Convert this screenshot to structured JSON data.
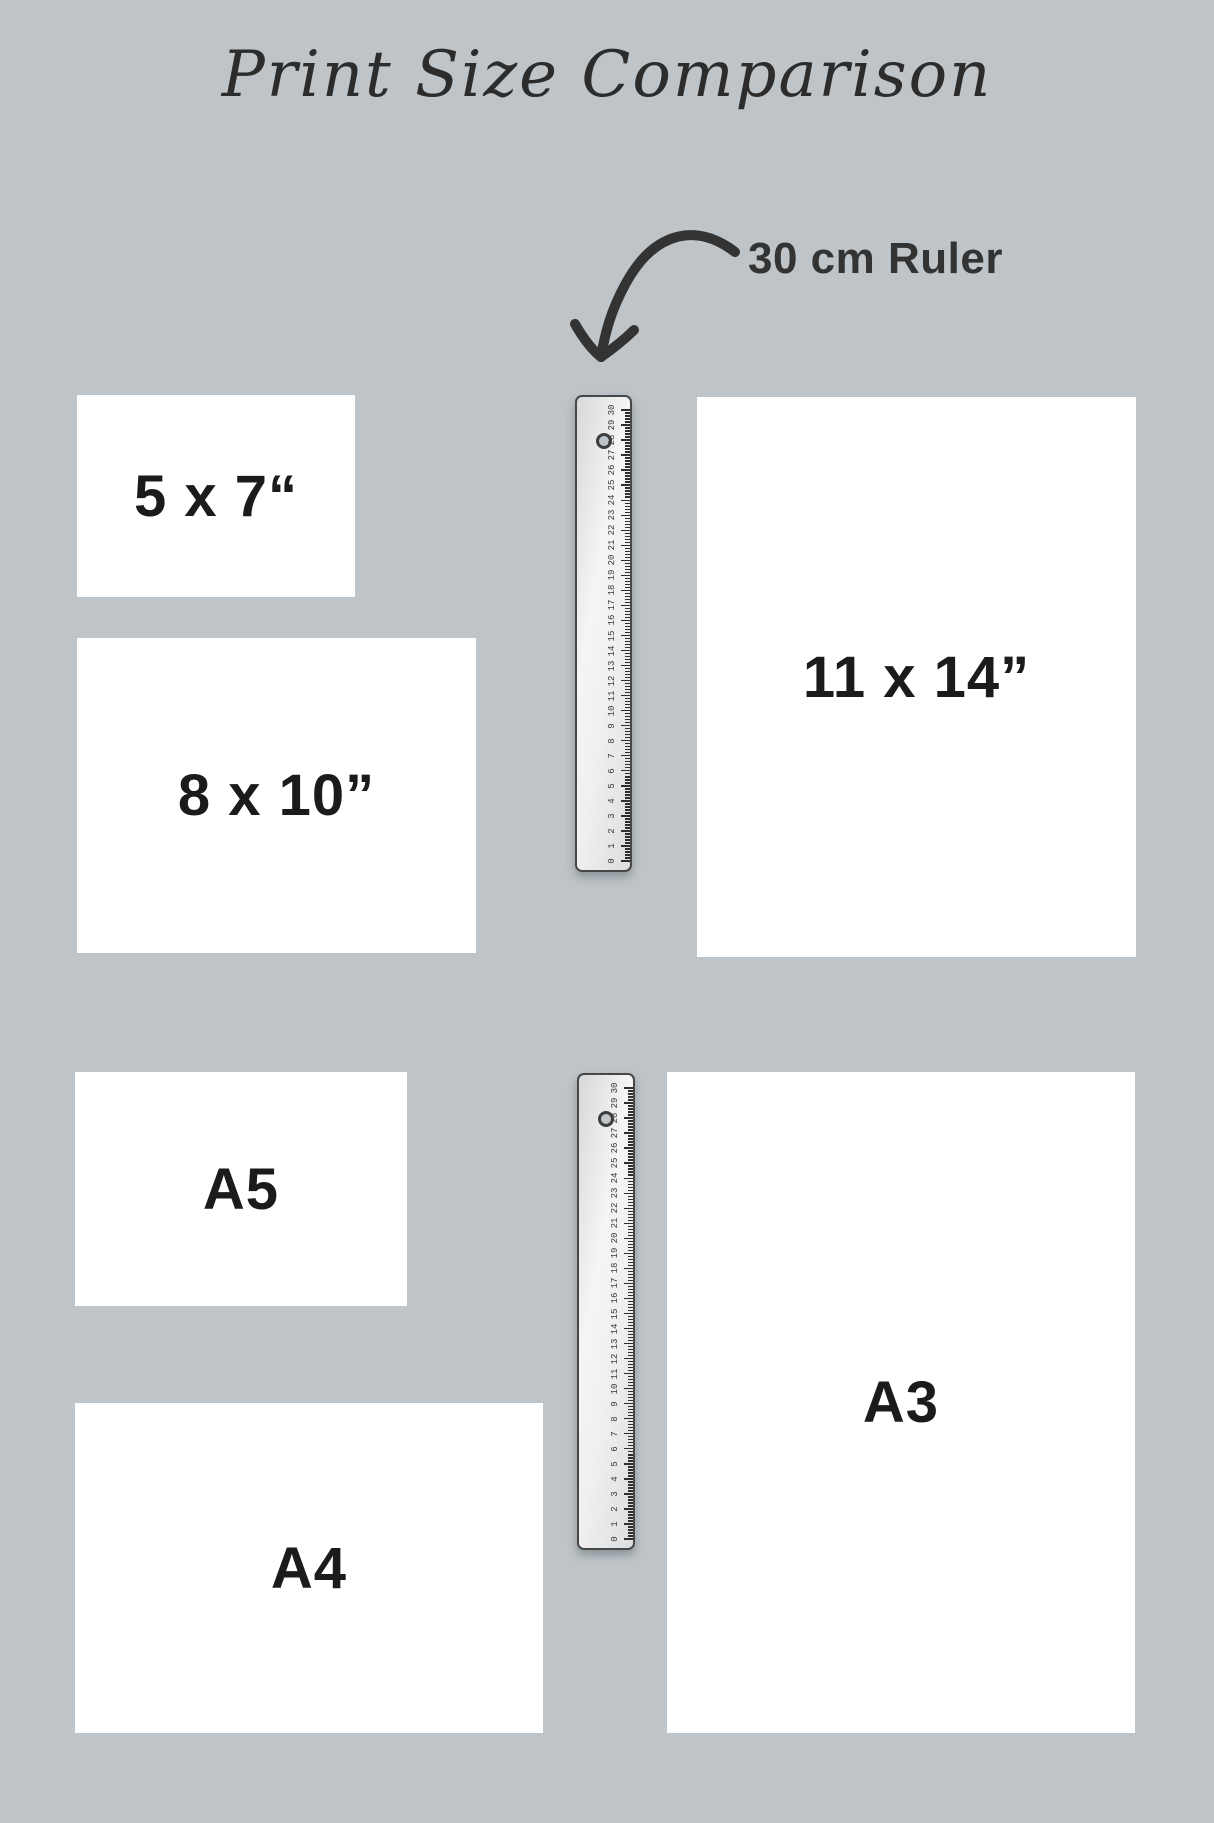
{
  "title": {
    "text": "Print Size Comparison"
  },
  "annotation": {
    "label": "30 cm Ruler"
  },
  "prints": [
    {
      "id": "5x7",
      "label": "5 x 7“",
      "x": 77,
      "y": 395,
      "w": 278,
      "h": 202
    },
    {
      "id": "8x10",
      "label": "8 x 10”",
      "x": 77,
      "y": 638,
      "w": 399,
      "h": 315
    },
    {
      "id": "11x14",
      "label": "11 x 14”",
      "x": 697,
      "y": 397,
      "w": 439,
      "h": 560
    },
    {
      "id": "a5",
      "label": "A5",
      "x": 75,
      "y": 1072,
      "w": 332,
      "h": 234
    },
    {
      "id": "a4",
      "label": "A4",
      "x": 75,
      "y": 1403,
      "w": 468,
      "h": 330
    },
    {
      "id": "a3",
      "label": "A3",
      "x": 667,
      "y": 1072,
      "w": 468,
      "h": 661
    }
  ],
  "rulers": [
    {
      "id": "ruler-top",
      "x": 575,
      "y": 395,
      "w": 57,
      "h": 477
    },
    {
      "id": "ruler-bottom",
      "x": 577,
      "y": 1073,
      "w": 58,
      "h": 477
    }
  ],
  "ruler_scale": {
    "unit": "cm",
    "min": 0,
    "max": 30,
    "minor_per_unit": 5
  },
  "colors": {
    "background": "#bec4c8",
    "paper": "#ffffff",
    "ink": "#2c2c2c",
    "ink_dark": "#1b1b1b",
    "label": "#333333"
  }
}
